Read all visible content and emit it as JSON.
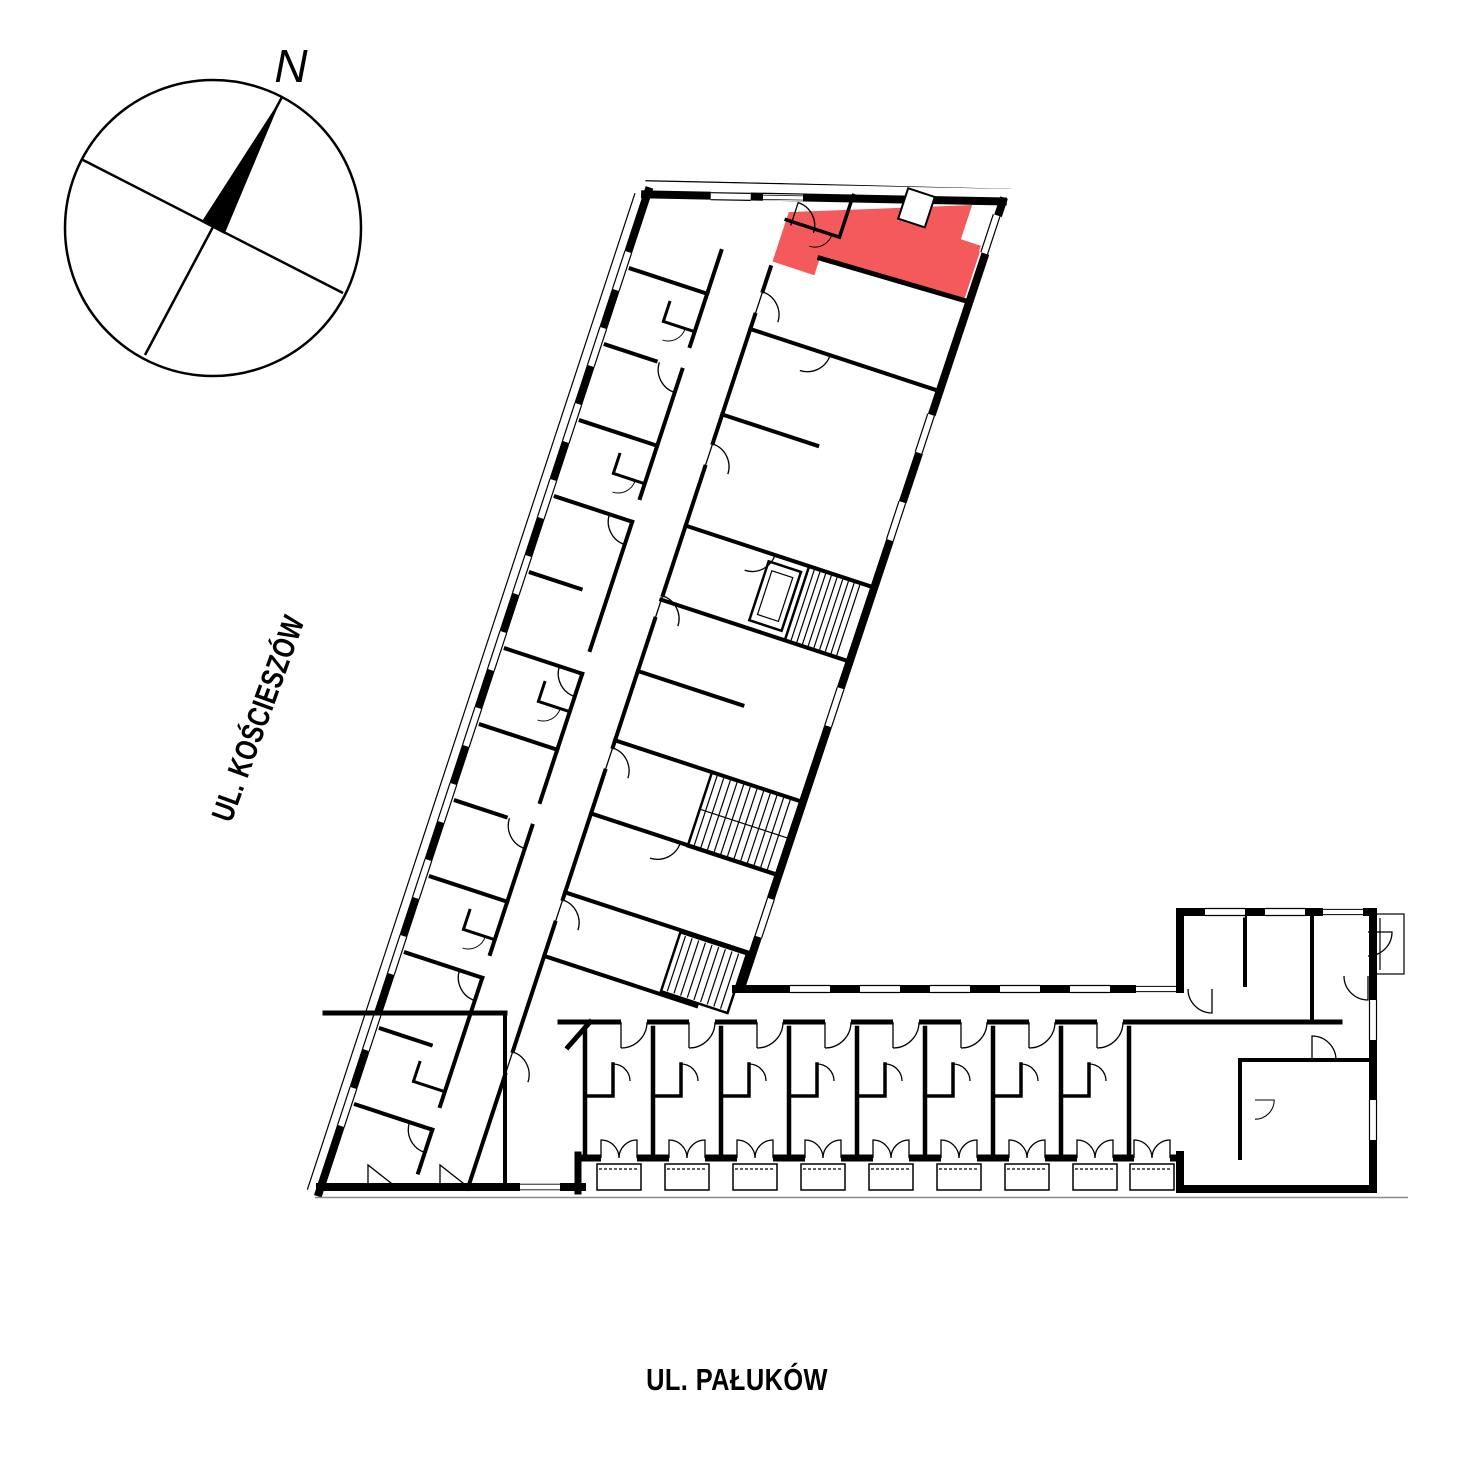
{
  "compass": {
    "label": "N"
  },
  "streets": {
    "left": "UL. KOŚCIESZÓW",
    "bottom": "UL. PAŁUKÓW"
  },
  "colors": {
    "highlight": "#f4595b",
    "walls": "#000000",
    "background": "#ffffff",
    "ground_line": "#8a8a8a"
  },
  "plan": {
    "type": "floor-plan",
    "highlighted_units_count": 1
  }
}
